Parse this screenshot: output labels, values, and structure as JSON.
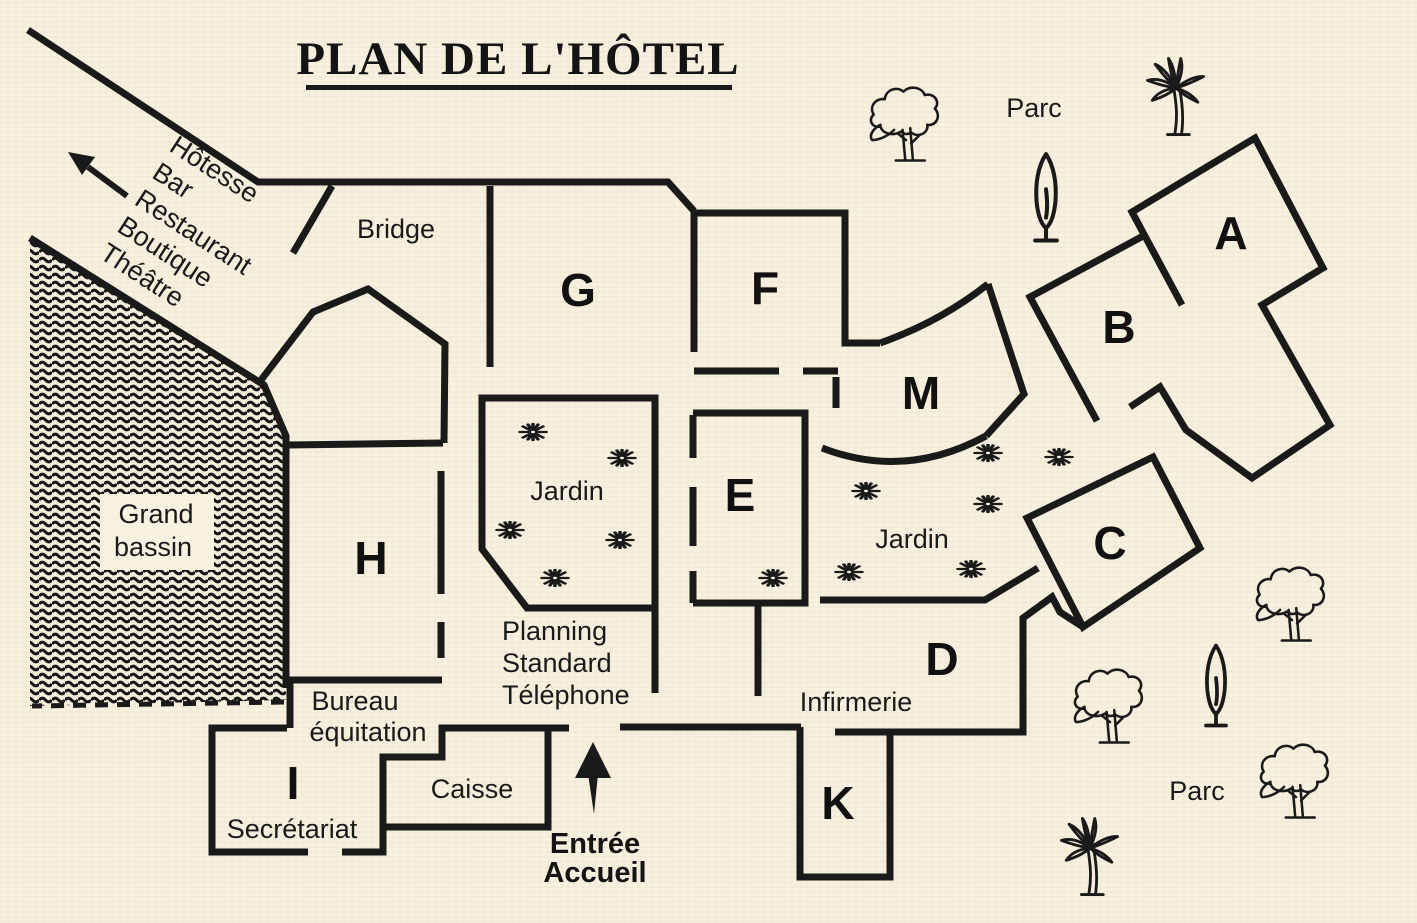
{
  "title": "PLAN DE L'HÔTEL",
  "direction_sign": {
    "items": [
      "Hôtesse",
      "Bar",
      "Restaurant",
      "Boutique",
      "Théâtre"
    ]
  },
  "rooms": [
    {
      "letter": "G"
    },
    {
      "letter": "F"
    },
    {
      "letter": "A"
    },
    {
      "letter": "B"
    },
    {
      "letter": "M"
    },
    {
      "letter": "E"
    },
    {
      "letter": "C"
    },
    {
      "letter": "H"
    },
    {
      "letter": "D"
    },
    {
      "letter": "K"
    },
    {
      "letter": "I"
    }
  ],
  "labels": {
    "bridge": "Bridge",
    "jardin_left": "Jardin",
    "jardin_right": "Jardin",
    "infirmerie": "Infirmerie",
    "caisse": "Caisse",
    "secretariat": "Secrétariat",
    "bureau_line1": "Bureau",
    "bureau_line2": "équitation",
    "planning_line1": "Planning",
    "planning_line2": "Standard",
    "planning_line3": "Téléphone"
  },
  "water": {
    "line1": "Grand",
    "line2": "bassin"
  },
  "entrance": {
    "line1": "Entrée",
    "line2": "Accueil"
  },
  "park": {
    "top": "Parc",
    "bottom": "Parc"
  },
  "colors": {
    "paper": "#f7f1e0",
    "ink": "#1a1a1a"
  }
}
